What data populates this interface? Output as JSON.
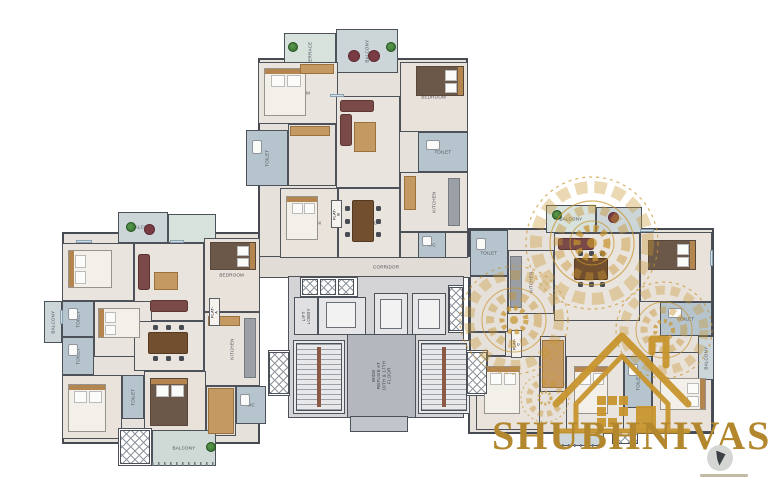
{
  "canvas": {
    "width": 770,
    "height": 483,
    "background": "#ffffff"
  },
  "brand": {
    "name": "SHUBHNIVAS",
    "color": "#b3872e"
  },
  "palette": {
    "wall": "#4d525a",
    "floor": "#e7e1db",
    "wet": "#b6c5cd",
    "balcony": "#ccd6d9",
    "terrace": "#d8e2dd",
    "gold": "#c8952f",
    "wood": "#c59a62",
    "sofa": "#7a4a48",
    "core": "#d4d4d6"
  },
  "rooms": [
    {
      "name": "top-wing-base",
      "x": 258,
      "y": 58,
      "w": 210,
      "h": 200,
      "fill": "#e7e1db",
      "cls": "base"
    },
    {
      "name": "left-wing-base",
      "x": 62,
      "y": 232,
      "w": 198,
      "h": 212,
      "fill": "#e7e1db",
      "cls": "base"
    },
    {
      "name": "right-wing-base",
      "x": 468,
      "y": 228,
      "w": 246,
      "h": 206,
      "fill": "#e7e1db",
      "cls": "base"
    },
    {
      "name": "corridor",
      "label": "CORRIDOR",
      "x": 230,
      "y": 256,
      "w": 312,
      "h": 22,
      "fill": "#e2dcd7"
    },
    {
      "name": "core-base",
      "x": 288,
      "y": 276,
      "w": 176,
      "h": 142,
      "fill": "#d4d4d6"
    },
    {
      "name": "terrace-top",
      "label": "TERRACE",
      "x": 284,
      "y": 33,
      "w": 52,
      "h": 40,
      "fill": "#d8e2dd",
      "rot": 1
    },
    {
      "name": "balcony-top",
      "label": "BALCONY",
      "x": 336,
      "y": 29,
      "w": 62,
      "h": 44,
      "fill": "#ccd6d9",
      "rot": 1
    },
    {
      "name": "bedroom-b1",
      "label": "BEDROOM",
      "x": 258,
      "y": 62,
      "w": 80,
      "h": 62,
      "fill": "#eae4de"
    },
    {
      "name": "toilet-b1",
      "label": "TOILET",
      "x": 246,
      "y": 130,
      "w": 42,
      "h": 56,
      "fill": "#b6c5cd",
      "rot": 1
    },
    {
      "name": "passage-b",
      "x": 288,
      "y": 124,
      "w": 48,
      "h": 62,
      "fill": "#e6e0da"
    },
    {
      "name": "living-b",
      "label": "LIVING",
      "x": 336,
      "y": 96,
      "w": 64,
      "h": 92,
      "fill": "#eae4de"
    },
    {
      "name": "bedroom-b2",
      "label": "BEDROOM",
      "x": 400,
      "y": 62,
      "w": 68,
      "h": 70,
      "fill": "#e9e2da"
    },
    {
      "name": "toilet-b2",
      "label": "TOILET",
      "x": 418,
      "y": 132,
      "w": 50,
      "h": 40,
      "fill": "#b6c5cd"
    },
    {
      "name": "kitchen-b",
      "label": "KITCHEN",
      "x": 400,
      "y": 172,
      "w": 68,
      "h": 60,
      "fill": "#e8e2dc",
      "rot": 1
    },
    {
      "name": "bedroom-b3",
      "label": "BEDROOM",
      "x": 280,
      "y": 188,
      "w": 58,
      "h": 70,
      "fill": "#e9e3dc"
    },
    {
      "name": "dining-b",
      "label": "DINING",
      "x": 338,
      "y": 188,
      "w": 62,
      "h": 70,
      "fill": "#eae4de"
    },
    {
      "name": "foyer-b",
      "x": 400,
      "y": 232,
      "w": 68,
      "h": 26,
      "fill": "#e6e0da"
    },
    {
      "name": "wc-b",
      "label": "WC",
      "x": 418,
      "y": 232,
      "w": 28,
      "h": 26,
      "fill": "#b6c5cd"
    },
    {
      "name": "flat-b-tag",
      "label": "FLAT-B",
      "x": 331,
      "y": 200,
      "w": 11,
      "h": 28,
      "fill": "#f6f3ef",
      "rot": 1,
      "cls": "tag"
    },
    {
      "name": "balcony-a-top",
      "label": "BALCONY",
      "x": 118,
      "y": 212,
      "w": 50,
      "h": 31,
      "fill": "#ccd6d9"
    },
    {
      "name": "terrace-a-top",
      "x": 168,
      "y": 214,
      "w": 48,
      "h": 29,
      "fill": "#d8e2dd"
    },
    {
      "name": "bedroom-a1",
      "label": "BEDROOM",
      "x": 62,
      "y": 243,
      "w": 72,
      "h": 58,
      "fill": "#eae4de"
    },
    {
      "name": "living-a",
      "label": "LIVING",
      "x": 134,
      "y": 243,
      "w": 70,
      "h": 78,
      "fill": "#eae4de"
    },
    {
      "name": "bedroom-a2",
      "label": "BEDROOM",
      "x": 204,
      "y": 238,
      "w": 56,
      "h": 74,
      "fill": "#e9e2da"
    },
    {
      "name": "toilet-a1",
      "label": "TOILET",
      "x": 62,
      "y": 301,
      "w": 32,
      "h": 36,
      "fill": "#b6c5cd",
      "rot": 1
    },
    {
      "name": "balcony-a-left",
      "label": "BALCONY",
      "x": 44,
      "y": 301,
      "w": 18,
      "h": 42,
      "fill": "#ccd6d9",
      "rot": 1
    },
    {
      "name": "toilet-a2",
      "label": "TOILET",
      "x": 62,
      "y": 337,
      "w": 32,
      "h": 38,
      "fill": "#b6c5cd",
      "rot": 1
    },
    {
      "name": "bedroom-a3",
      "label": "BEDROOM",
      "x": 94,
      "y": 301,
      "w": 58,
      "h": 56,
      "fill": "#eae4de"
    },
    {
      "name": "dining-a",
      "label": "DINING",
      "x": 134,
      "y": 321,
      "w": 70,
      "h": 50,
      "fill": "#eae4de"
    },
    {
      "name": "kitchen-a",
      "label": "KITCHEN",
      "x": 204,
      "y": 312,
      "w": 56,
      "h": 74,
      "fill": "#e8e2dc",
      "rot": 1
    },
    {
      "name": "bedroom-a4",
      "label": "BEDROOM",
      "x": 62,
      "y": 375,
      "w": 60,
      "h": 64,
      "fill": "#e9e3dc"
    },
    {
      "name": "toilet-a3",
      "label": "TOILET",
      "x": 122,
      "y": 375,
      "w": 22,
      "h": 44,
      "fill": "#b6c5cd",
      "rot": 1
    },
    {
      "name": "bedroom-a5",
      "label": "BEDROOM",
      "x": 144,
      "y": 371,
      "w": 62,
      "h": 64,
      "fill": "#e9e2da"
    },
    {
      "name": "dresser-a",
      "x": 206,
      "y": 386,
      "w": 30,
      "h": 50,
      "fill": "#e4dedb"
    },
    {
      "name": "wc-a",
      "label": "WC",
      "x": 236,
      "y": 386,
      "w": 30,
      "h": 38,
      "fill": "#b6c5cd"
    },
    {
      "name": "ledge-a-bottom",
      "x": 118,
      "y": 428,
      "w": 34,
      "h": 38,
      "fill": "#ffffff"
    },
    {
      "name": "balcony-a-bottom",
      "label": "BALCONY",
      "x": 152,
      "y": 430,
      "w": 64,
      "h": 36,
      "fill": "#cfd9d6"
    },
    {
      "name": "flat-a-tag",
      "label": "FLAT-A",
      "x": 209,
      "y": 298,
      "w": 11,
      "h": 28,
      "fill": "#f6f3ef",
      "rot": 1,
      "cls": "tag"
    },
    {
      "name": "balcony-c-top",
      "label": "BALCONY",
      "x": 546,
      "y": 205,
      "w": 50,
      "h": 28,
      "fill": "#d8e2dd"
    },
    {
      "name": "terrace-c-top",
      "x": 596,
      "y": 207,
      "w": 46,
      "h": 26,
      "fill": "#ccd6d9"
    },
    {
      "name": "toilet-c1",
      "label": "TOILET",
      "x": 470,
      "y": 230,
      "w": 38,
      "h": 46,
      "fill": "#b6c5cd"
    },
    {
      "name": "kitchen-c",
      "label": "KITCHEN",
      "x": 508,
      "y": 250,
      "w": 46,
      "h": 64,
      "fill": "#e8e2dc",
      "rot": 1
    },
    {
      "name": "passage-c",
      "x": 470,
      "y": 276,
      "w": 38,
      "h": 56,
      "fill": "#e6e0da"
    },
    {
      "name": "living-c",
      "label": "LIVING",
      "x": 554,
      "y": 233,
      "w": 86,
      "h": 88,
      "fill": "#eae4de"
    },
    {
      "name": "bedroom-c1",
      "label": "BEDROOM",
      "x": 640,
      "y": 232,
      "w": 72,
      "h": 70,
      "fill": "#e9e2da"
    },
    {
      "name": "toilet-c2",
      "label": "TOILET",
      "x": 660,
      "y": 302,
      "w": 52,
      "h": 34,
      "fill": "#b6c5cd"
    },
    {
      "name": "store-c",
      "x": 470,
      "y": 332,
      "w": 36,
      "h": 24,
      "fill": "#e6e0da"
    },
    {
      "name": "bedroom-c2",
      "label": "BEDROOM",
      "x": 476,
      "y": 356,
      "w": 64,
      "h": 74,
      "fill": "#e9e3dc"
    },
    {
      "name": "utility-c",
      "x": 540,
      "y": 336,
      "w": 26,
      "h": 56,
      "fill": "#e4dedb"
    },
    {
      "name": "bedroom-c3",
      "label": "BEDROOM",
      "x": 566,
      "y": 356,
      "w": 58,
      "h": 74,
      "fill": "#eae4de"
    },
    {
      "name": "toilet-c3",
      "label": "TOILET",
      "x": 624,
      "y": 356,
      "w": 28,
      "h": 52,
      "fill": "#b6c5cd",
      "rot": 1
    },
    {
      "name": "bedroom-c4",
      "label": "BEDROOM",
      "x": 652,
      "y": 352,
      "w": 60,
      "h": 80,
      "fill": "#e9e2da"
    },
    {
      "name": "balcony-c-right",
      "label": "BALCONY",
      "x": 698,
      "y": 336,
      "w": 16,
      "h": 44,
      "fill": "#ccd6d9",
      "rot": 1
    },
    {
      "name": "balcony-c-bottom",
      "x": 556,
      "y": 432,
      "w": 48,
      "h": 14,
      "fill": "#ccd6d9"
    },
    {
      "name": "flat-c-tag",
      "label": "FLAT-C",
      "x": 511,
      "y": 330,
      "w": 11,
      "h": 28,
      "fill": "#f6f3ef",
      "rot": 1,
      "cls": "tag"
    },
    {
      "name": "lift-lobby",
      "label": "LIFT\nLOBBY",
      "x": 294,
      "y": 297,
      "w": 24,
      "h": 38,
      "fill": "#e0e0e2",
      "rot": 1
    },
    {
      "name": "lift-1",
      "label": "LIFT",
      "x": 318,
      "y": 297,
      "w": 48,
      "h": 38,
      "fill": "#e6e6e8"
    },
    {
      "name": "lift-2",
      "label": "LIFT",
      "x": 374,
      "y": 293,
      "w": 34,
      "h": 42,
      "fill": "#e6e6e8"
    },
    {
      "name": "lift-3",
      "label": "LIFT",
      "x": 412,
      "y": 293,
      "w": 34,
      "h": 42,
      "fill": "#e6e6e8"
    },
    {
      "name": "duct-row",
      "x": 300,
      "y": 277,
      "w": 58,
      "h": 20,
      "fill": "#ffffff"
    },
    {
      "name": "shaft-right",
      "x": 448,
      "y": 285,
      "w": 16,
      "h": 48,
      "fill": "#ffffff"
    },
    {
      "name": "staircase-left",
      "x": 293,
      "y": 340,
      "w": 52,
      "h": 74,
      "fill": "#e9e9eb"
    },
    {
      "name": "staircase-right",
      "x": 418,
      "y": 340,
      "w": 52,
      "h": 74,
      "fill": "#e9e9eb"
    },
    {
      "name": "refuge-shaft",
      "label": "WIDE REFUGE AT\n10TH & 17TH FLOOR",
      "x": 347,
      "y": 334,
      "w": 69,
      "h": 84,
      "fill": "#b4b8be",
      "rot": 1,
      "cls": "light"
    },
    {
      "name": "core-stub",
      "x": 350,
      "y": 416,
      "w": 58,
      "h": 16,
      "fill": "#c2c6cb"
    },
    {
      "name": "ac-ledge-left",
      "label": "AC\nLEDGE",
      "x": 268,
      "y": 350,
      "w": 22,
      "h": 46,
      "fill": "#ffffff",
      "rot": 1
    },
    {
      "name": "ac-ledge-right",
      "label": "AC\nLEDGE",
      "x": 466,
      "y": 350,
      "w": 22,
      "h": 46,
      "fill": "#ffffff",
      "rot": 1
    }
  ],
  "furniture": [
    {
      "type": "bed",
      "x": 264,
      "y": 68,
      "w": 42,
      "h": 48,
      "dir": "n"
    },
    {
      "type": "bed",
      "x": 286,
      "y": 196,
      "w": 32,
      "h": 44,
      "dir": "n"
    },
    {
      "type": "bed",
      "x": 68,
      "y": 250,
      "w": 44,
      "h": 38,
      "dir": "w"
    },
    {
      "type": "bed",
      "x": 98,
      "y": 308,
      "w": 42,
      "h": 30,
      "dir": "w"
    },
    {
      "type": "bed",
      "x": 68,
      "y": 384,
      "w": 38,
      "h": 48,
      "dir": "n"
    },
    {
      "type": "bed",
      "x": 484,
      "y": 366,
      "w": 36,
      "h": 48,
      "dir": "n"
    },
    {
      "type": "bed",
      "x": 574,
      "y": 366,
      "w": 34,
      "h": 48,
      "dir": "n"
    },
    {
      "type": "bed",
      "x": 660,
      "y": 378,
      "w": 46,
      "h": 32,
      "dir": "e"
    },
    {
      "type": "bedD",
      "x": 416,
      "y": 66,
      "w": 48,
      "h": 30,
      "dir": "e"
    },
    {
      "type": "bedD",
      "x": 210,
      "y": 242,
      "w": 46,
      "h": 28,
      "dir": "e"
    },
    {
      "type": "bedD",
      "x": 150,
      "y": 378,
      "w": 38,
      "h": 48,
      "dir": "n"
    },
    {
      "type": "bedD",
      "x": 648,
      "y": 240,
      "w": 48,
      "h": 30,
      "dir": "e"
    },
    {
      "type": "table",
      "x": 352,
      "y": 200,
      "w": 22,
      "h": 42
    },
    {
      "type": "table",
      "x": 148,
      "y": 332,
      "w": 40,
      "h": 22
    },
    {
      "type": "table",
      "x": 574,
      "y": 258,
      "w": 34,
      "h": 22
    },
    {
      "type": "rtable",
      "x": 348,
      "y": 50,
      "w": 12,
      "h": 12
    },
    {
      "type": "rtable",
      "x": 368,
      "y": 50,
      "w": 12,
      "h": 12
    },
    {
      "type": "rtable",
      "x": 144,
      "y": 224,
      "w": 11,
      "h": 11
    },
    {
      "type": "rtable",
      "x": 608,
      "y": 212,
      "w": 11,
      "h": 11
    },
    {
      "type": "sofa",
      "x": 340,
      "y": 100,
      "w": 34,
      "h": 12
    },
    {
      "type": "sofa",
      "x": 340,
      "y": 114,
      "w": 12,
      "h": 32
    },
    {
      "type": "sofa",
      "x": 138,
      "y": 254,
      "w": 12,
      "h": 36
    },
    {
      "type": "sofa",
      "x": 150,
      "y": 300,
      "w": 38,
      "h": 12
    },
    {
      "type": "sofa",
      "x": 558,
      "y": 238,
      "w": 36,
      "h": 12
    },
    {
      "type": "wood",
      "x": 354,
      "y": 122,
      "w": 22,
      "h": 30
    },
    {
      "type": "wood",
      "x": 154,
      "y": 272,
      "w": 24,
      "h": 18
    },
    {
      "type": "counter",
      "x": 448,
      "y": 178,
      "w": 12,
      "h": 48
    },
    {
      "type": "wood",
      "x": 404,
      "y": 176,
      "w": 12,
      "h": 34
    },
    {
      "type": "counter",
      "x": 244,
      "y": 318,
      "w": 12,
      "h": 60
    },
    {
      "type": "wood",
      "x": 208,
      "y": 316,
      "w": 32,
      "h": 10
    },
    {
      "type": "counter",
      "x": 510,
      "y": 256,
      "w": 12,
      "h": 52
    },
    {
      "type": "wood",
      "x": 300,
      "y": 64,
      "w": 34,
      "h": 10
    },
    {
      "type": "wood",
      "x": 290,
      "y": 126,
      "w": 40,
      "h": 10
    },
    {
      "type": "wood",
      "x": 208,
      "y": 388,
      "w": 26,
      "h": 46
    },
    {
      "type": "wood",
      "x": 542,
      "y": 340,
      "w": 22,
      "h": 48
    },
    {
      "type": "stairs",
      "x": 296,
      "y": 343,
      "w": 46,
      "h": 68
    },
    {
      "type": "stairs",
      "x": 421,
      "y": 343,
      "w": 46,
      "h": 68
    },
    {
      "type": "hatch",
      "x": 302,
      "y": 279,
      "w": 16,
      "h": 16
    },
    {
      "type": "hatch",
      "x": 320,
      "y": 279,
      "w": 16,
      "h": 16
    },
    {
      "type": "hatch",
      "x": 338,
      "y": 279,
      "w": 16,
      "h": 16
    },
    {
      "type": "hatch",
      "x": 449,
      "y": 287,
      "w": 14,
      "h": 44
    },
    {
      "type": "hatch",
      "x": 269,
      "y": 352,
      "w": 20,
      "h": 42
    },
    {
      "type": "hatch",
      "x": 467,
      "y": 352,
      "w": 20,
      "h": 42
    },
    {
      "type": "hatch",
      "x": 120,
      "y": 430,
      "w": 30,
      "h": 34
    },
    {
      "type": "hatch",
      "x": 612,
      "y": 432,
      "w": 26,
      "h": 12
    },
    {
      "type": "liftcar",
      "x": 326,
      "y": 302,
      "w": 30,
      "h": 26
    },
    {
      "type": "liftcar",
      "x": 380,
      "y": 299,
      "w": 22,
      "h": 30
    },
    {
      "type": "liftcar",
      "x": 418,
      "y": 299,
      "w": 22,
      "h": 30
    },
    {
      "type": "plant",
      "x": 288,
      "y": 42,
      "w": 10,
      "h": 10
    },
    {
      "type": "plant",
      "x": 386,
      "y": 42,
      "w": 10,
      "h": 10
    },
    {
      "type": "plant",
      "x": 126,
      "y": 222,
      "w": 10,
      "h": 10
    },
    {
      "type": "plant",
      "x": 206,
      "y": 442,
      "w": 10,
      "h": 10
    },
    {
      "type": "plant",
      "x": 552,
      "y": 210,
      "w": 10,
      "h": 10
    },
    {
      "type": "fix",
      "x": 252,
      "y": 140,
      "w": 10,
      "h": 14
    },
    {
      "type": "fix",
      "x": 426,
      "y": 140,
      "w": 14,
      "h": 10
    },
    {
      "type": "fix",
      "x": 68,
      "y": 308,
      "w": 10,
      "h": 12
    },
    {
      "type": "fix",
      "x": 68,
      "y": 344,
      "w": 10,
      "h": 12
    },
    {
      "type": "fix",
      "x": 240,
      "y": 394,
      "w": 10,
      "h": 12
    },
    {
      "type": "fix",
      "x": 476,
      "y": 238,
      "w": 10,
      "h": 12
    },
    {
      "type": "fix",
      "x": 668,
      "y": 308,
      "w": 14,
      "h": 10
    },
    {
      "type": "fix",
      "x": 628,
      "y": 364,
      "w": 10,
      "h": 12
    },
    {
      "type": "fix",
      "x": 422,
      "y": 236,
      "w": 10,
      "h": 10
    },
    {
      "type": "rail",
      "x": 152,
      "y": 462,
      "w": 64,
      "h": 4
    },
    {
      "type": "rail",
      "x": 556,
      "y": 444,
      "w": 48,
      "h": 3
    },
    {
      "type": "win",
      "x": 76,
      "y": 240,
      "w": 16,
      "h": 3
    },
    {
      "type": "win",
      "x": 170,
      "y": 240,
      "w": 14,
      "h": 3
    },
    {
      "type": "win",
      "x": 330,
      "y": 94,
      "w": 14,
      "h": 3
    },
    {
      "type": "win",
      "x": 640,
      "y": 229,
      "w": 14,
      "h": 3
    },
    {
      "type": "win",
      "x": 710,
      "y": 250,
      "w": 3,
      "h": 16
    },
    {
      "type": "win",
      "x": 60,
      "y": 310,
      "w": 3,
      "h": 14
    }
  ]
}
